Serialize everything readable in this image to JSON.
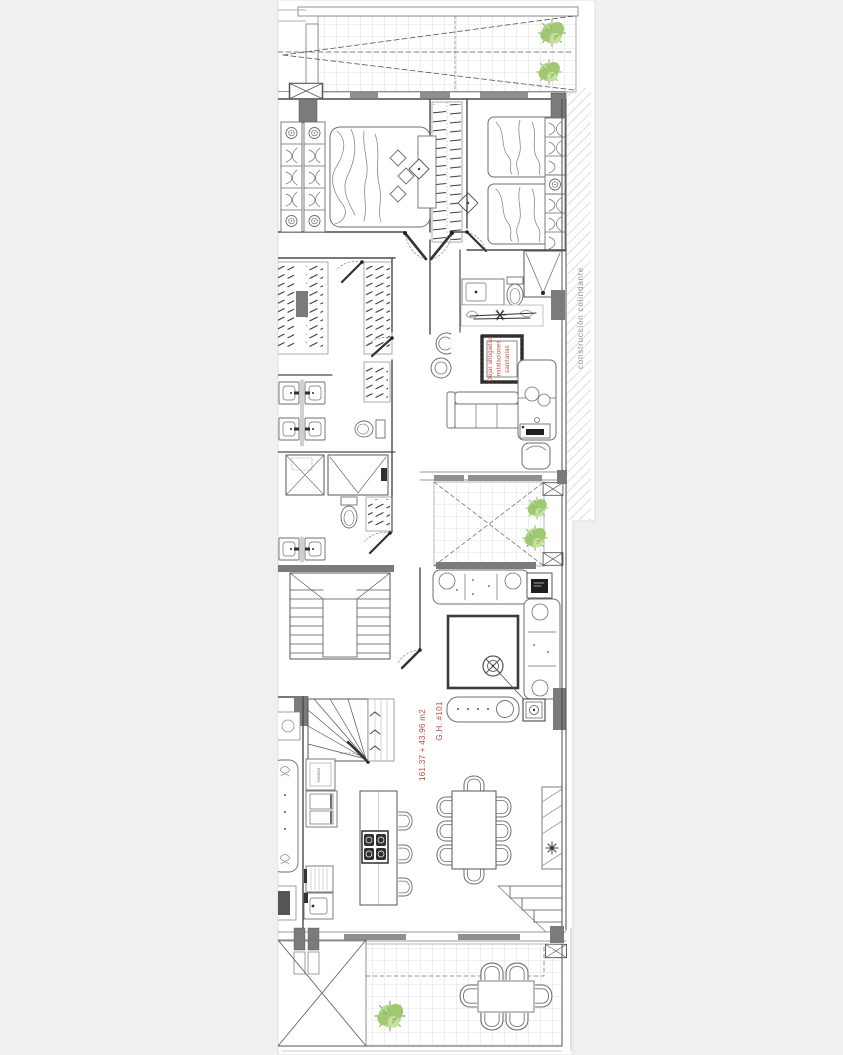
{
  "document": {
    "kind": "architectural-floor-plan",
    "background": "#eff0f1",
    "paper": "#ffffff"
  },
  "palette": {
    "wall": "#4a4a4a",
    "furniture_line": "#6e6e6e",
    "light_line": "#999999",
    "grid_line": "#d2d8da",
    "column_fill": "#7b7b7b",
    "hatch_line": "#c9c9c9",
    "window_fill": "#8f8f8f",
    "plant_green": "#a0c873",
    "plant_green_light": "#c6e0a1",
    "annotation_red": "#c04a42",
    "boundary_text_gray": "#8f8f8f"
  },
  "annotations": {
    "shaft_note": {
      "lines": [
        "Dejar ahogadas",
        "instalaciones",
        "sanitarias"
      ],
      "color": "#c04a42",
      "rotation_deg": -90
    },
    "unit_label": {
      "name": "G.H. #101",
      "area": "161.37 + 43.96 m2",
      "color": "#c04a42",
      "rotation_deg": -90
    },
    "boundary_label": {
      "text": "construcción colindante",
      "color": "#8f8f8f",
      "rotation_deg": -90
    },
    "appliance_label": {
      "text": "Hornos",
      "color": "#777777",
      "rotation_deg": -90
    }
  },
  "icons": {
    "column-marker-icon": "rectangle with X cross",
    "structural-column-icon": "solid gray rectangle",
    "plant-icon": "green shrub cluster with spikes",
    "target-knob-icon": "concentric circles",
    "chair-icon": "double U arc",
    "hanger-rack-icon": "rows of slanted ticks"
  }
}
